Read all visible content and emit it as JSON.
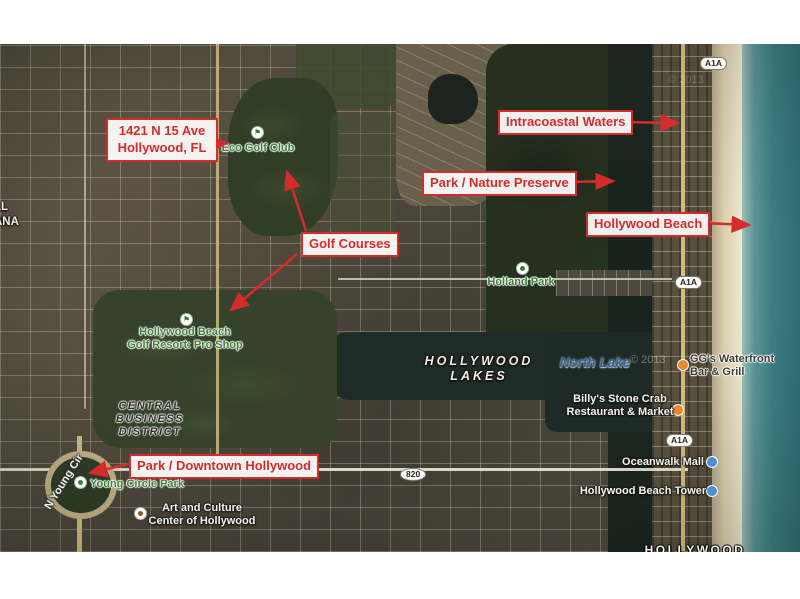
{
  "annotations": {
    "accent_color": "#d62b2b",
    "address": {
      "line1": "1421 N 15 Ave",
      "line2": "Hollywood, FL"
    },
    "intracoastal": "Intracoastal Waters",
    "nature_preserve": "Park / Nature Preserve",
    "hollywood_beach": "Hollywood Beach",
    "golf_courses": "Golf Courses",
    "downtown": "Park / Downtown Hollywood"
  },
  "labels": {
    "eco_golf_club": "Eco Golf Club",
    "golf_resort_line1": "Hollywood Beach",
    "golf_resort_line2": "Golf Resort: Pro Shop",
    "holland_park": "Holland Park",
    "hollywood_lakes_line1": "HOLLYWOOD",
    "hollywood_lakes_line2": "LAKES",
    "north_lake": "North Lake",
    "cbd_line1": "CENTRAL",
    "cbd_line2": "BUSINESS",
    "cbd_line3": "DISTRICT",
    "young_circle_park": "Young Circle Park",
    "n_young_cir": "N Young Cir",
    "art_culture_line1": "Art and Culture",
    "art_culture_line2": "Center of Hollywood",
    "billys_line1": "Billy's Stone Crab",
    "billys_line2": "Restaurant & Market",
    "ggs_line1": "GG's Waterfront",
    "ggs_line2": "Bar & Grill",
    "oceanwalk_mall": "Oceanwalk Mall",
    "hollywood_beach_tower": "Hollywood Beach Tower",
    "city_name": "HOLLYWOOD",
    "neighborhood_fragment_line1": "LL",
    "neighborhood_fragment_line2": "ANA",
    "shield_a1a": "A1A",
    "shield_820": "820",
    "watermark": "© 2013"
  },
  "colors": {
    "annotation_red": "#d62b2b",
    "park_label_green": "#3c8038",
    "water_label_blue": "#35629c",
    "ocean_teal": "#3f8286",
    "beach_sand": "#d9cfae",
    "preserve_green": "#25301f",
    "urban_base": "#4b463b"
  }
}
